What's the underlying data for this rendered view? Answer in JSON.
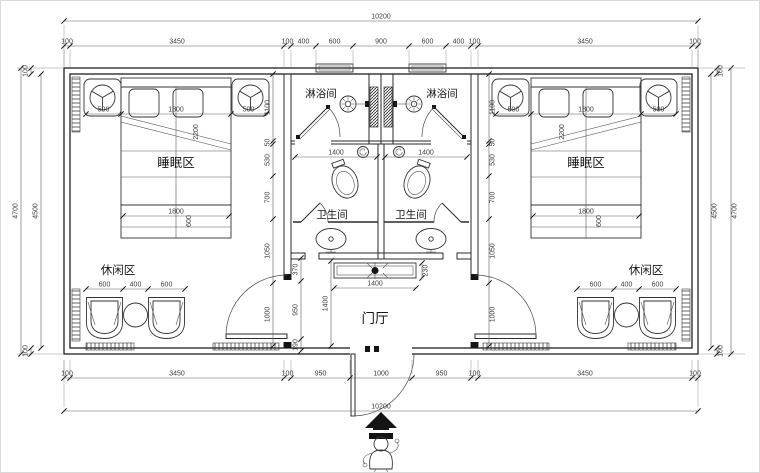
{
  "plan": {
    "rooms": {
      "sleeping_left": "睡眠区",
      "sleeping_right": "睡眠区",
      "leisure_left": "休闲区",
      "leisure_right": "休闲区",
      "shower_left": "淋浴间",
      "shower_right": "淋浴间",
      "toilet_left": "卫生间",
      "toilet_right": "卫生间",
      "foyer": "门厅"
    },
    "dims": {
      "overall_top": "10200",
      "overall_bottom": "10200",
      "top_row": [
        "100",
        "3450",
        "100",
        "400",
        "600",
        "900",
        "600",
        "400",
        "100",
        "3450",
        "100"
      ],
      "bottom_row": [
        "100",
        "3450",
        "100",
        "950",
        "1000",
        "950",
        "100",
        "3450",
        "100"
      ],
      "left_outer": "4700",
      "left_inner": "4500",
      "left_top": "100",
      "left_bottom": "100",
      "right_outer": "4700",
      "right_inner": "4500",
      "right_top": "100",
      "right_bottom": "100",
      "bed_left": [
        "500",
        "1800",
        "500"
      ],
      "bed_right": [
        "500",
        "1800",
        "500"
      ],
      "bed_diag_left": "2200",
      "bed_diag_right": "2200",
      "bed_foot_left": "1800",
      "bed_foot_right": "1800",
      "bed_foot_depth_left": "600",
      "bed_foot_depth_right": "600",
      "chairs_left": [
        "600",
        "400",
        "600"
      ],
      "chairs_right": [
        "600",
        "400",
        "600"
      ],
      "bath_left": "1400",
      "bath_right": "1400",
      "mid_left": [
        "1100",
        "50",
        "530",
        "700",
        "1050",
        "1000"
      ],
      "mid_right": [
        "1100",
        "50",
        "530",
        "700",
        "1050",
        "1000"
      ],
      "foyer_chain": [
        "370",
        "950",
        "190"
      ],
      "foyer_depth": "1400",
      "console_width": "1400",
      "console_depth": "230"
    },
    "icons": {
      "entry_direction": "up-arrow",
      "entrance_figure": "person"
    }
  }
}
